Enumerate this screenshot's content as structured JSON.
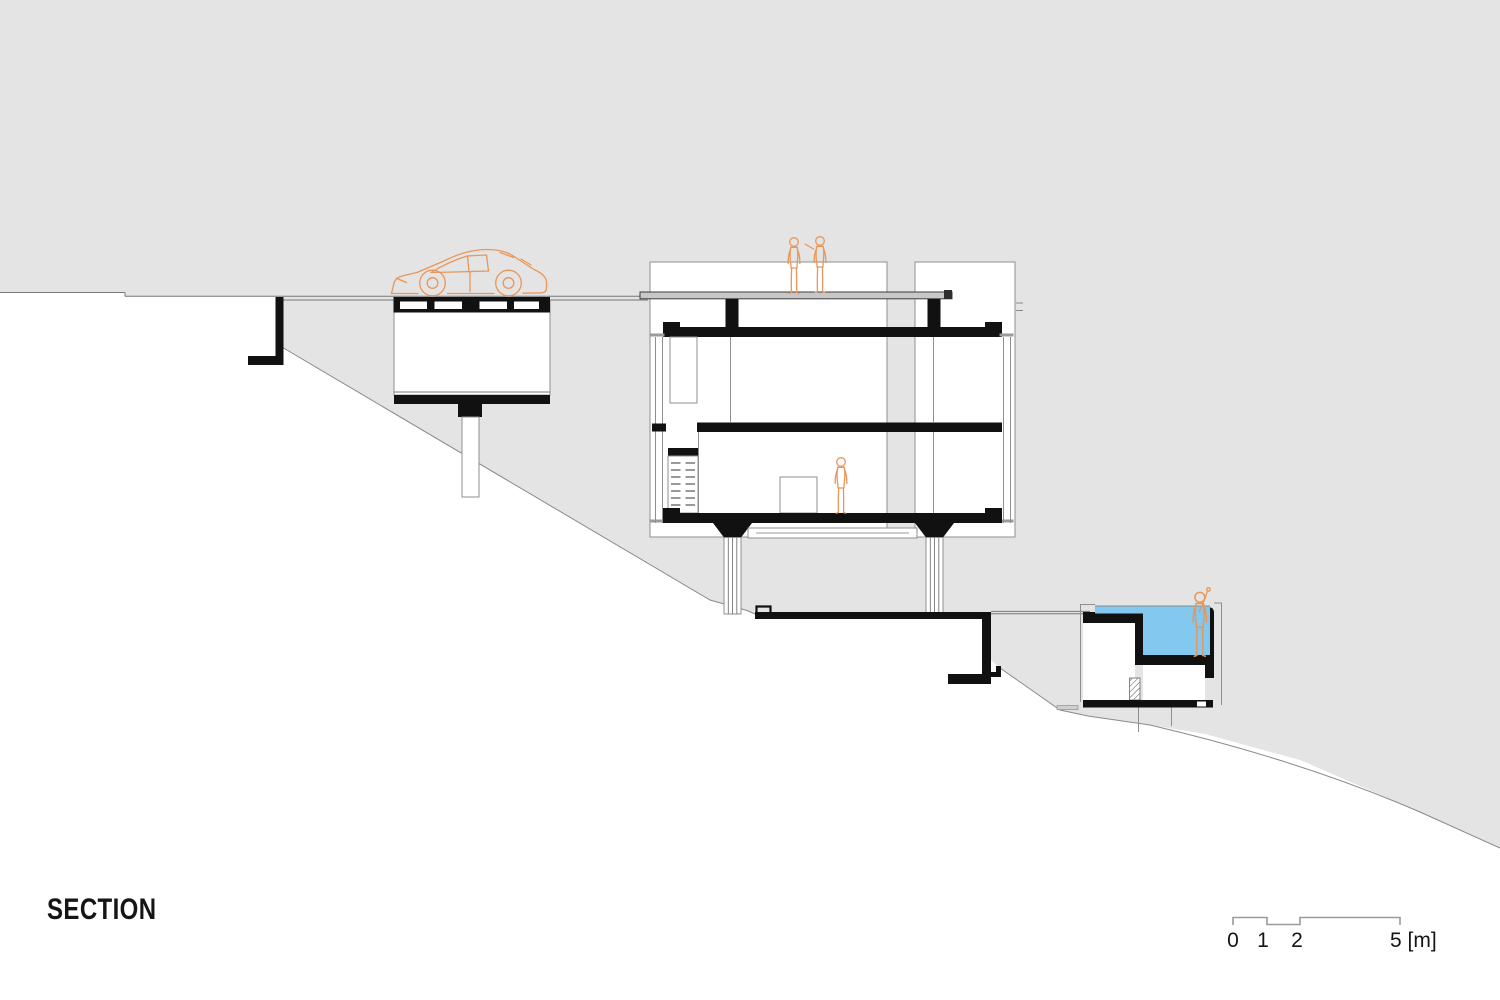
{
  "drawing": {
    "type": "architectural-section",
    "title": {
      "label": "SECTION"
    },
    "scale_bar": {
      "tick_0": "0",
      "tick_1": "1",
      "tick_2": "2",
      "tick_5": "5 [m]",
      "units": "meters"
    },
    "colors": {
      "hill": "#e4e4e4",
      "ink": "#111111",
      "water": "#82c8ef",
      "figure": "#e8965a",
      "deck": "#c8c8c8",
      "outline": "#8f8f8f"
    },
    "icons": {
      "car-icon": "sports car side-view outline on upper driveway",
      "person-icon": "mannequin human figure outline",
      "pool-water": "light blue water fill of the plunge pool"
    },
    "elements": {
      "hillside": "gray sloping ground mass descending left to right",
      "upper_road": "driveway at top of slope with parked car",
      "garage_box": "suspended garage volume hanging below the road on a single column",
      "upper_retaining_wall": "L-shaped retaining wall left of the garage",
      "main_house": "two-storey living volume with roof terrace, two stub columns, black floor slabs and striped pilotis",
      "roof_terrace_figures": "two people standing on the roof deck",
      "living_room_figure": "one person standing in the lower living room",
      "suspended_walkway": "thin deck hung between the pilotis below the house",
      "lower_terrace": "black terrace path with retaining wall below the house",
      "pool_house": "lowest volume with plunge pool, hatched party wall and two small rooms",
      "pool_figure": "person standing in the pool waving"
    }
  }
}
